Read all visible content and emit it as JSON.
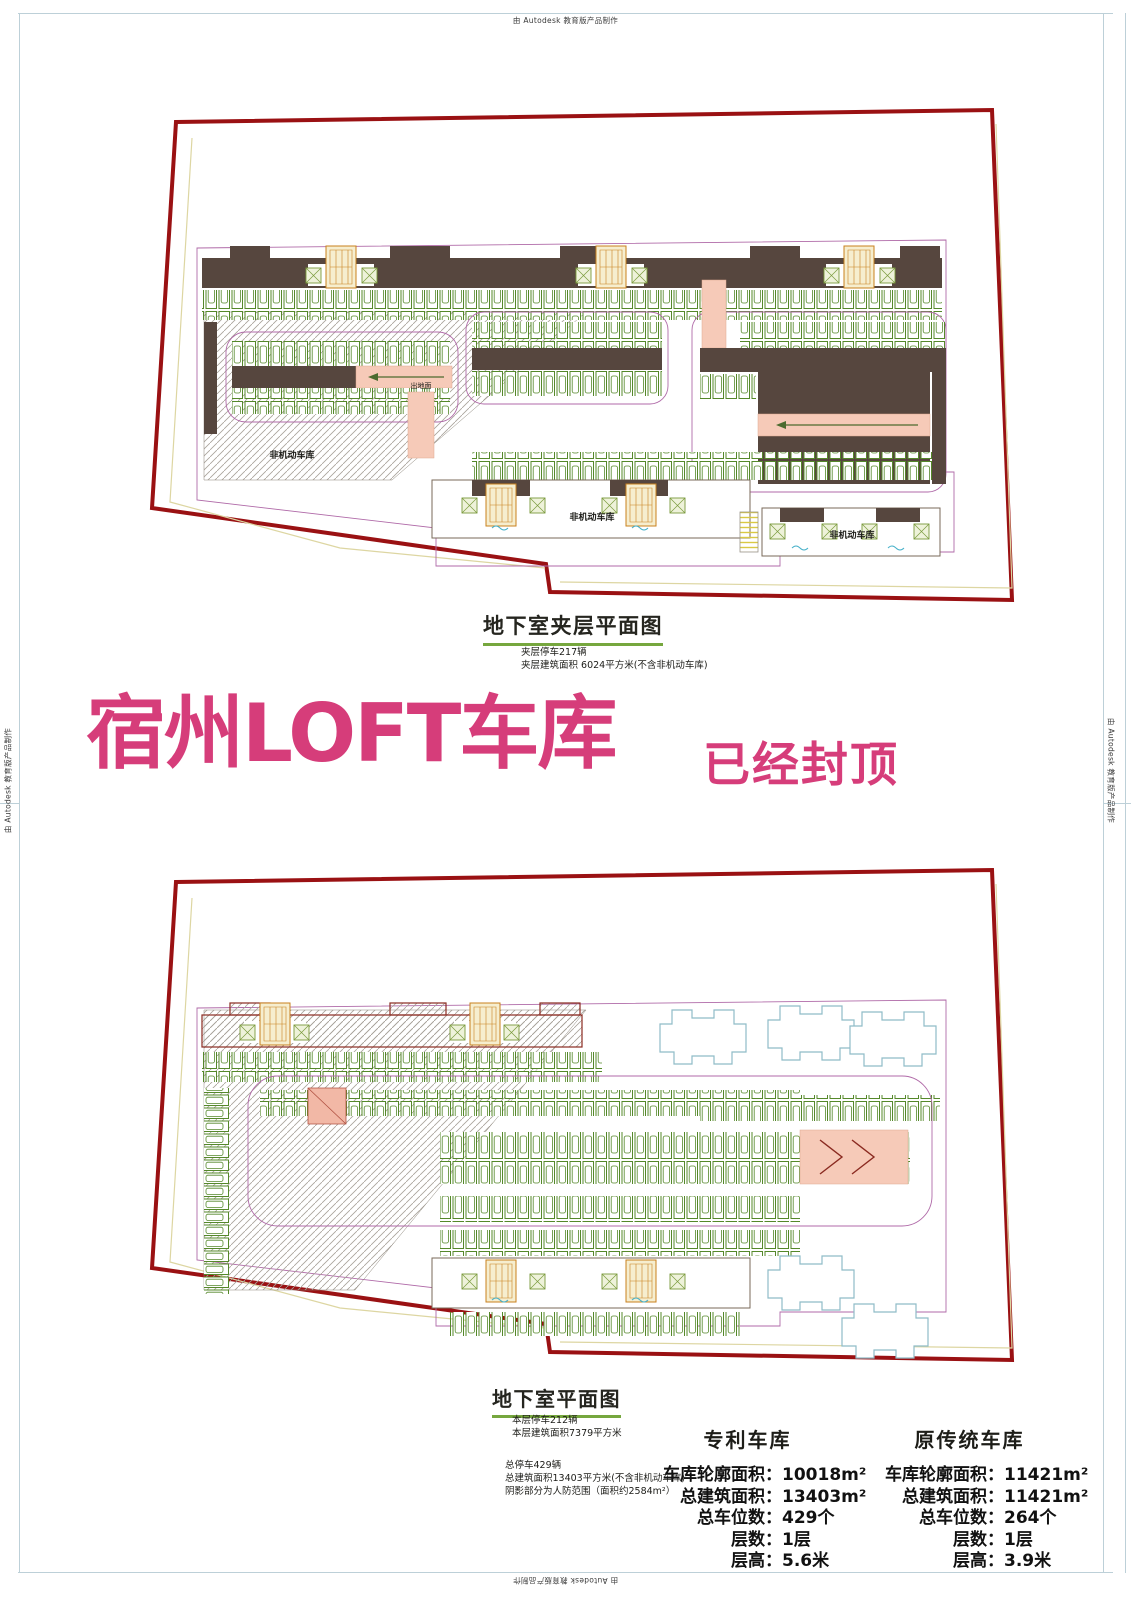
{
  "page": {
    "autodesk_credit": "由 Autodesk 教育版产品制作"
  },
  "colors": {
    "accent_pink": "#d63d7a",
    "boundary_red": "#9a1113",
    "stall_green": "#55882a",
    "deck_brown": "#56463e",
    "ramp_pink": "#f6cab8",
    "tower_cyan": "#8fbcc8",
    "underline_green": "#76a73e",
    "frame_blue": "#bdd0d8"
  },
  "title_block": {
    "title": "宿州LOFT车库",
    "status": "已经封顶"
  },
  "plan_mezzanine": {
    "name": "地下室夹层平面图",
    "notes": {
      "0": "夹层停车217辆",
      "1": "夹层建筑面积 6024平方米(不含非机动车库)"
    },
    "labels": {
      "non_motor_left": "非机动车库",
      "non_motor_center": "非机动车库",
      "non_motor_right": "非机动车库",
      "exit_ground_1": "出地面",
      "exit_ground_2": "出地面"
    }
  },
  "plan_basement": {
    "name": "地下室平面图",
    "notes": {
      "0": "本层停车212辆",
      "1": "本层建筑面积7379平方米"
    },
    "summary": {
      "0": "总停车429辆",
      "1": "总建筑面积13403平方米(不含非机动车库)",
      "2": "阴影部分为人防范围（面积约2584m²）"
    }
  },
  "stats": {
    "patent": {
      "title": "专利车库",
      "rows": {
        "0": {
          "label": "车库轮廓面积：",
          "value": "10018m²"
        },
        "1": {
          "label": "总建筑面积：",
          "value": "13403m²"
        },
        "2": {
          "label": "总车位数：",
          "value": "429个"
        },
        "3": {
          "label": "层数：",
          "value": "1层"
        },
        "4": {
          "label": "层高：",
          "value": "5.6米"
        }
      }
    },
    "traditional": {
      "title": "原传统车库",
      "rows": {
        "0": {
          "label": "车库轮廓面积：",
          "value": "11421m²"
        },
        "1": {
          "label": "总建筑面积：",
          "value": "11421m²"
        },
        "2": {
          "label": "总车位数：",
          "value": "264个"
        },
        "3": {
          "label": "层数：",
          "value": "1层"
        },
        "4": {
          "label": "层高：",
          "value": "3.9米"
        }
      }
    }
  }
}
